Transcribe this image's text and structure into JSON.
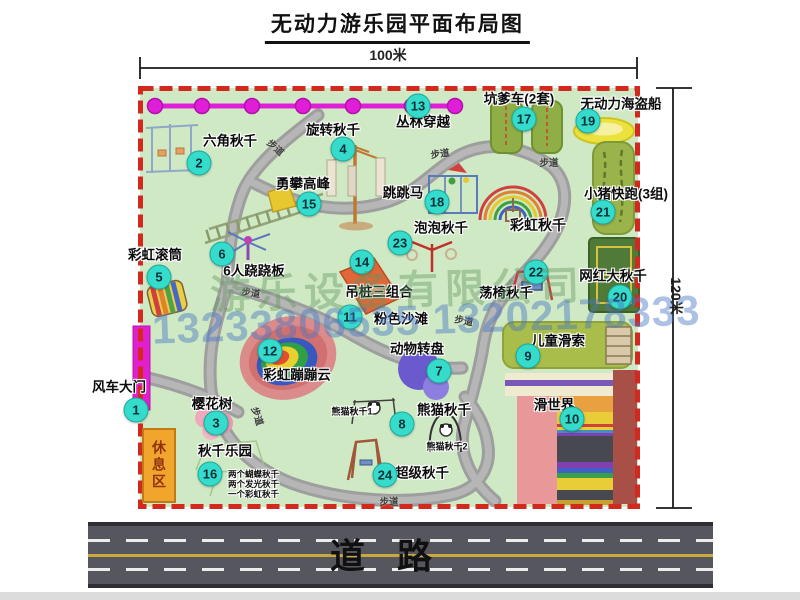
{
  "title": "无动力游乐园平面布局图",
  "dimensions": {
    "top": "100米",
    "right": "120米"
  },
  "road": {
    "label": "道路"
  },
  "rest_area": {
    "label": "休息区"
  },
  "watermark": {
    "company": "游乐设备有限公司",
    "phone": "13233806535 13202178333"
  },
  "walkway": {
    "text": "步道",
    "positions": [
      [
        276,
        147,
        42
      ],
      [
        440,
        153,
        -8
      ],
      [
        549,
        162,
        0
      ],
      [
        251,
        292,
        8
      ],
      [
        258,
        416,
        72
      ],
      [
        464,
        320,
        10
      ],
      [
        389,
        501,
        0
      ]
    ]
  },
  "attractions": [
    {
      "num": 1,
      "name": "风车大门",
      "badge": [
        136,
        410
      ],
      "label": [
        119,
        387
      ]
    },
    {
      "num": 2,
      "name": "六角秋千",
      "badge": [
        199,
        163
      ],
      "label": [
        230,
        141
      ]
    },
    {
      "num": 3,
      "name": "樱花树",
      "badge": [
        216,
        423
      ],
      "label": [
        212,
        404
      ]
    },
    {
      "num": 4,
      "name": "旋转秋千",
      "badge": [
        343,
        149
      ],
      "label": [
        333,
        130
      ]
    },
    {
      "num": 5,
      "name": "彩虹滚筒",
      "badge": [
        159,
        277
      ],
      "label": [
        155,
        255
      ]
    },
    {
      "num": 6,
      "name": "6人跷跷板",
      "badge": [
        222,
        254
      ],
      "label": [
        254,
        271
      ]
    },
    {
      "num": 7,
      "name": "动物转盘",
      "badge": [
        439,
        371
      ],
      "label": [
        417,
        349
      ]
    },
    {
      "num": 8,
      "name": "熊猫秋千",
      "badge": [
        402,
        424
      ],
      "label": [
        444,
        410
      ]
    },
    {
      "num": 9,
      "name": "儿童滑索",
      "badge": [
        528,
        356
      ],
      "label": [
        558,
        341
      ]
    },
    {
      "num": 10,
      "name": "滑世界",
      "badge": [
        572,
        419
      ],
      "label": [
        554,
        405
      ]
    },
    {
      "num": 11,
      "name": "粉色沙滩",
      "badge": [
        350,
        317
      ],
      "label": [
        401,
        319
      ]
    },
    {
      "num": 12,
      "name": "彩虹蹦蹦云",
      "badge": [
        270,
        351
      ],
      "label": [
        297,
        375
      ]
    },
    {
      "num": 13,
      "name": "丛林穿越",
      "badge": [
        418,
        106
      ],
      "label": [
        423,
        122
      ]
    },
    {
      "num": 14,
      "name": "吊桩三组合",
      "badge": [
        362,
        262
      ],
      "label": [
        379,
        292
      ]
    },
    {
      "num": 15,
      "name": "勇攀高峰",
      "badge": [
        309,
        204
      ],
      "label": [
        303,
        184
      ]
    },
    {
      "num": 16,
      "name": "秋千乐园",
      "badge": [
        210,
        474
      ],
      "label": [
        225,
        451
      ]
    },
    {
      "num": 17,
      "name": "坑爹车(2套)",
      "badge": [
        524,
        119
      ],
      "label": [
        519,
        99
      ]
    },
    {
      "num": 18,
      "name": "跳跳马",
      "badge": [
        437,
        202
      ],
      "label": [
        403,
        193
      ]
    },
    {
      "num": 19,
      "name": "无动力海盗船",
      "badge": [
        588,
        121
      ],
      "label": [
        621,
        104
      ]
    },
    {
      "num": 20,
      "name": "网红大秋千",
      "badge": [
        620,
        297
      ],
      "label": [
        613,
        276
      ]
    },
    {
      "num": 21,
      "name": "小猪快跑(3组)",
      "badge": [
        603,
        212
      ],
      "label": [
        626,
        194
      ]
    },
    {
      "num": 22,
      "name": "荡椅秋千",
      "badge": [
        536,
        272
      ],
      "label": [
        506,
        293
      ]
    },
    {
      "num": 23,
      "name": "泡泡秋千",
      "badge": [
        400,
        243
      ],
      "label": [
        441,
        228
      ]
    },
    {
      "num": 24,
      "name": "超级秋千",
      "badge": [
        385,
        475
      ],
      "label": [
        422,
        473
      ]
    }
  ],
  "extra_labels": [
    {
      "id": "rainbow-swing",
      "text": "彩虹秋千",
      "x": 538,
      "y": 225,
      "size": 14
    },
    {
      "id": "panda-swing-1",
      "text": "熊猫秋千1",
      "x": 352,
      "y": 412,
      "size": 9
    },
    {
      "id": "panda-swing-2",
      "text": "熊猫秋千2",
      "x": 447,
      "y": 447,
      "size": 9
    },
    {
      "id": "swing-note-1",
      "text": "两个蝴蝶秋千",
      "x": 228,
      "y": 474,
      "size": 8.5,
      "align": "left"
    },
    {
      "id": "swing-note-2",
      "text": "两个发光秋千",
      "x": 228,
      "y": 484,
      "size": 8.5,
      "align": "left"
    },
    {
      "id": "swing-note-3",
      "text": "一个彩虹秋千",
      "x": 228,
      "y": 494,
      "size": 8.5,
      "align": "left"
    }
  ]
}
